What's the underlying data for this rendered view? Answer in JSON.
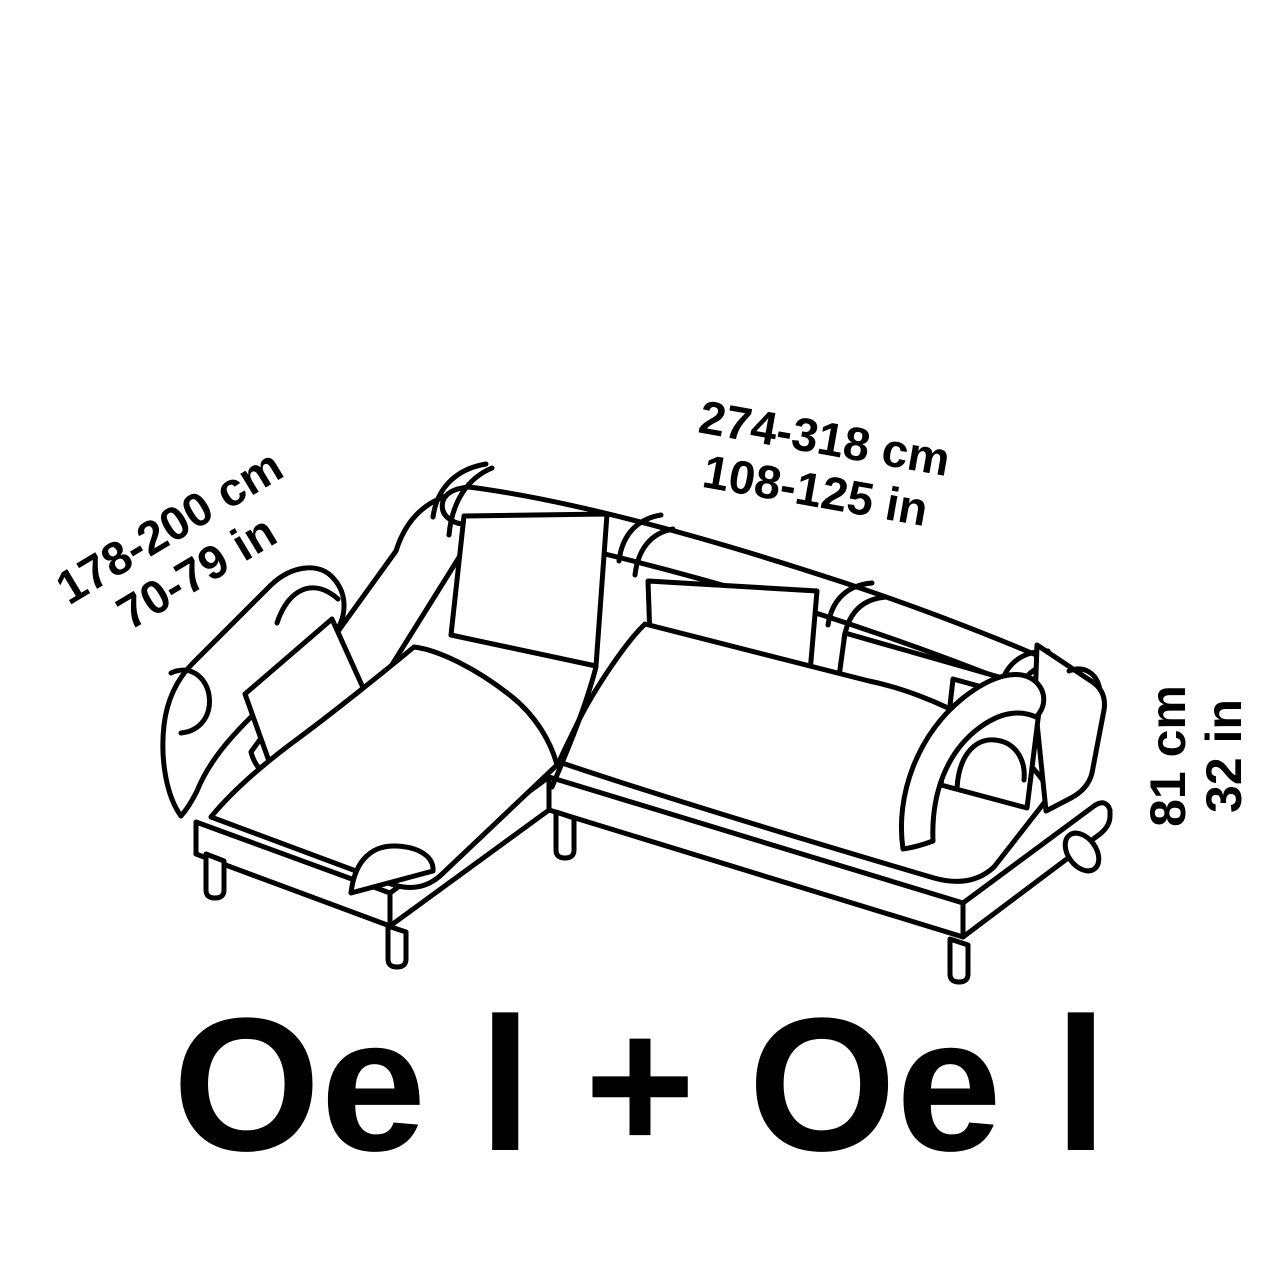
{
  "page": {
    "background_color": "#ffffff",
    "line_color": "#000000",
    "text_color": "#000000"
  },
  "diagram": {
    "drawing": "l-shaped-sectional-sofa-line-art",
    "labels": {
      "chaise_length": {
        "cm": "178-200 cm",
        "in": "70-79 in"
      },
      "overall_width": {
        "cm": "274-318 cm",
        "in": "108-125 in"
      },
      "overall_height": {
        "cm": "81 cm",
        "in": "32 in"
      }
    },
    "caption": "Oe l + Oe l"
  }
}
